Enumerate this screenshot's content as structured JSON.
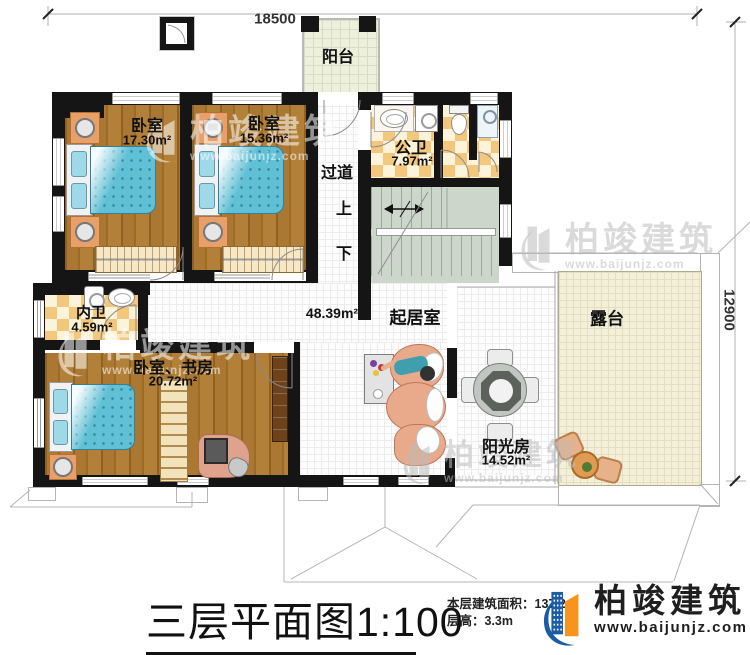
{
  "dimensions": {
    "top": "18500",
    "right": "12900"
  },
  "rooms": {
    "balcony": {
      "name": "阳台"
    },
    "bedroom1": {
      "name": "卧室",
      "area": "17.30m²"
    },
    "bedroom2": {
      "name": "卧室",
      "area": "15.36m²"
    },
    "public_bath": {
      "name": "公卫",
      "area": "7.97m²"
    },
    "corridor": {
      "name": "过道"
    },
    "private_bath": {
      "name": "内卫",
      "area": "4.59m²"
    },
    "study": {
      "name": "卧室、书房",
      "area": "20.72m²"
    },
    "living": {
      "name": "起居室",
      "area": "48.39m²"
    },
    "sunroom": {
      "name": "阳光房",
      "area": "14.52m²"
    },
    "terrace": {
      "name": "露台"
    }
  },
  "stairs": {
    "up": "上",
    "down": "下"
  },
  "title": "三层平面图1:100",
  "notes": {
    "building_area": "本层建筑面积：137.2",
    "floor_height": "层高：3.3m"
  },
  "brand": {
    "name": "柏竣建筑",
    "url": "www.baijunjz.com"
  },
  "watermark": {
    "name": "柏竣建筑",
    "url": "www.baijunjz.com"
  },
  "colors": {
    "wall": "#151515",
    "wood": "#a5742e",
    "bed_blue": "#5fc0d6",
    "tile_orange": "#f3c87d",
    "tile_cream": "#fdf2da",
    "stair_green": "#ccd6cb",
    "terrace_cream": "#f4efd8",
    "logo_blue": "#1b5ca6",
    "logo_orange": "#f7941e"
  }
}
